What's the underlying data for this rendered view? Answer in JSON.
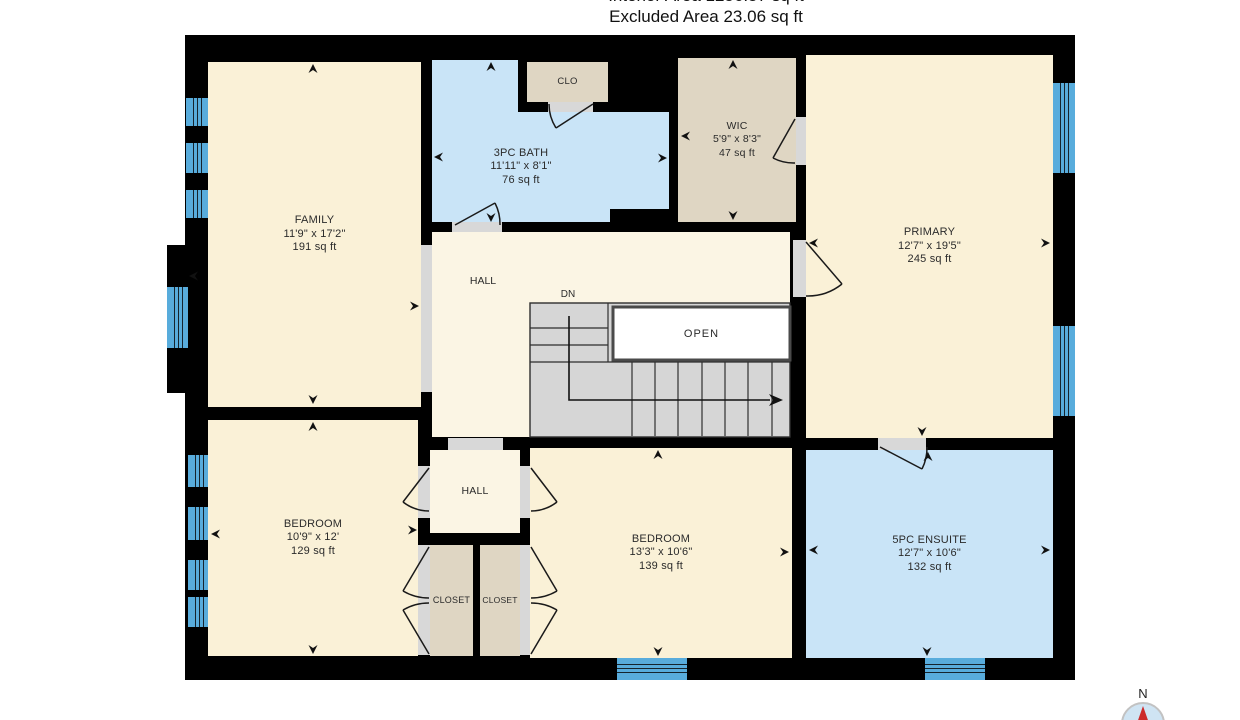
{
  "header": {
    "interior_area": "Interior Area 1256.57 sq ft",
    "excluded_area": "Excluded Area 23.06 sq ft"
  },
  "rooms": {
    "family": {
      "name": "FAMILY",
      "dims": "11'9\" x 17'2\"",
      "area": "191 sq ft"
    },
    "bath": {
      "name": "3PC BATH",
      "dims": "11'11\" x 8'1\"",
      "area": "76 sq ft"
    },
    "clo": {
      "name": "CLO"
    },
    "wic": {
      "name": "WIC",
      "dims": "5'9\" x 8'3\"",
      "area": "47 sq ft"
    },
    "primary": {
      "name": "PRIMARY",
      "dims": "12'7\" x 19'5\"",
      "area": "245 sq ft"
    },
    "hall_upper": {
      "name": "HALL"
    },
    "hall_lower": {
      "name": "HALL"
    },
    "stairs": {
      "down_label": "DN",
      "open_label": "OPEN"
    },
    "bedroom_left": {
      "name": "BEDROOM",
      "dims": "10'9\" x 12'",
      "area": "129 sq ft"
    },
    "closet_left": {
      "name": "CLOSET"
    },
    "closet_right": {
      "name": "CLOSET"
    },
    "bedroom_mid": {
      "name": "BEDROOM",
      "dims": "13'3\" x 10'6\"",
      "area": "139 sq ft"
    },
    "ensuite": {
      "name": "5PC ENSUITE",
      "dims": "12'7\" x 10'6\"",
      "area": "132 sq ft"
    }
  },
  "compass": {
    "north_label": "N"
  },
  "colors": {
    "wall": "#000000",
    "room_cream": "#FAF1D7",
    "room_blue": "#C9E4F7",
    "room_tan": "#DFD6C3",
    "window_blue": "#58ACDC",
    "stair_gray": "#D6D6D6",
    "threshold_gray": "#D8D8D8",
    "open_border": "#4A4A4A",
    "compass_red": "#CC2A2A"
  }
}
